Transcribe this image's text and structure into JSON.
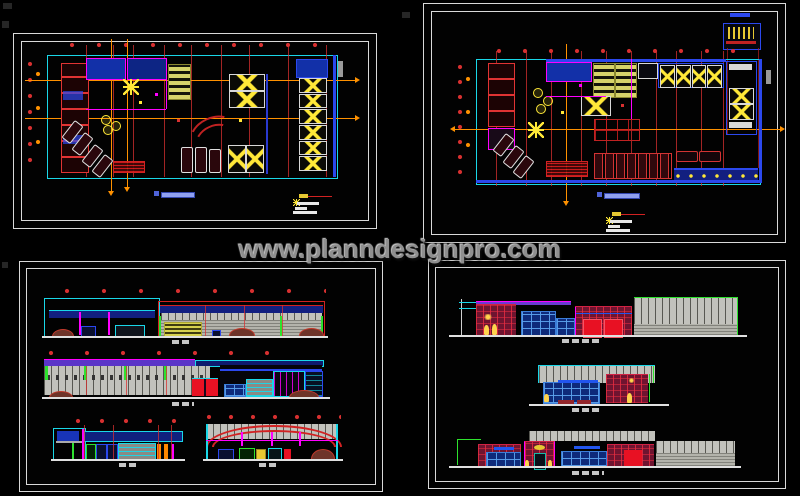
{
  "watermark": {
    "text": "www.planndesignpro.com"
  },
  "palette": {
    "background": "#000000",
    "sheet_border": "#d9d9d9",
    "grid_red": "#d83030",
    "orange": "#ff9100",
    "cyan": "#19d7e8",
    "blue": "#2b48ee",
    "navy": "#121f80",
    "magenta": "#ff00ff",
    "yellow": "#ffe838",
    "khaki": "#d6d36a",
    "green": "#2ee22e",
    "grey_wall": "#c2c2bc",
    "crimson": "#6f1430",
    "door_red": "#e81123",
    "mound": "#6e3429",
    "title_blue": "#8fa0f0",
    "watermark": "#8f8f8f"
  }
}
